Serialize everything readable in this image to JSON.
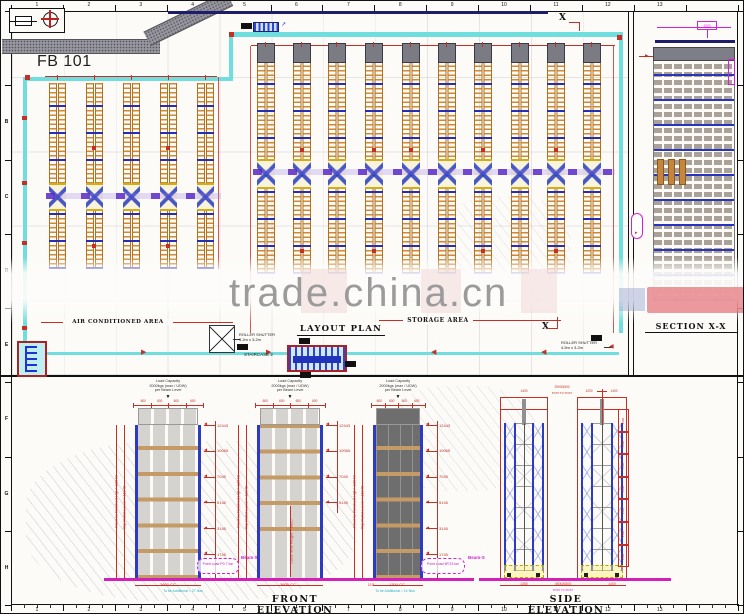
{
  "watermark": {
    "text": "trade.china.cn"
  },
  "rulers": {
    "top_numbers": [
      "1",
      "2",
      "3",
      "4",
      "5",
      "6",
      "7",
      "8",
      "9",
      "10",
      "11",
      "12",
      "13"
    ],
    "bottom_numbers": [
      "1",
      "2",
      "3",
      "4",
      "5",
      "6",
      "7",
      "8",
      "9",
      "10",
      "11",
      "12",
      "13"
    ],
    "left_letters": [
      "A",
      "B",
      "C",
      "D",
      "E",
      "F",
      "G",
      "H"
    ]
  },
  "plan": {
    "building_label": "FB 101",
    "ac_area_label": "AIR CONDITIONED AREA",
    "plan_title": "LAYOUT PLAN",
    "storage_area_label": "STORAGE AREA",
    "section_marker": "X",
    "roller_shutter_1_line1": "ROLLER SHUTTER",
    "roller_shutter_1_line2": "3.2m x 3.2m",
    "roller_shutter_2_line1": "ROLLER SHUTTER",
    "roller_shutter_2_line2": "4.5m x 3.2m",
    "staircase_label": "STAIRCASE 2",
    "ac_rack_count": 5,
    "storage_rack_count": 10
  },
  "section": {
    "title": "SECTION X-X",
    "top_dim": "1000"
  },
  "elevations": {
    "front_title": "FRONT ELEVATION",
    "side_title": "SIDE ELEVATION",
    "load_note_lines": [
      "Load Capacity",
      "2000kgs (max / UDW)",
      "per Beam Level"
    ],
    "top_cell_dim": "600",
    "front_level_dims": [
      "12443",
      "10065",
      "7045",
      "5145",
      "3145",
      "1745"
    ],
    "left_dim_inner": "Top Pallet Level ≈ 11948",
    "left_dim_outer": "Floor to Finished Hgt ≈ 12940",
    "clear_height_dim": "Clear Max Height ≈ 9065",
    "point_load_1": "Point Load P0.7 ton",
    "point_load_2": "Point Load 6P.23 ton",
    "beam_label": "Beam-S",
    "bottom_dim_1": "3600 CC",
    "bottom_dim_2": "3600 CC",
    "bottom_dim_3": "115",
    "bottom_dim_4": "1300 CC",
    "note_1": "To be Additional ≈ 27 Nos",
    "note_2": "To be Additional ≈ 14 Nos",
    "side_top_dims": [
      "1400",
      "2900/3600",
      "1200",
      "1400"
    ],
    "side_top_note": "POST TO POST",
    "side_level_dim": "1500",
    "side_bottom_dims": [
      "1350",
      "4500/5300",
      "1400"
    ],
    "side_bottom_note": "POST TO POST"
  }
}
